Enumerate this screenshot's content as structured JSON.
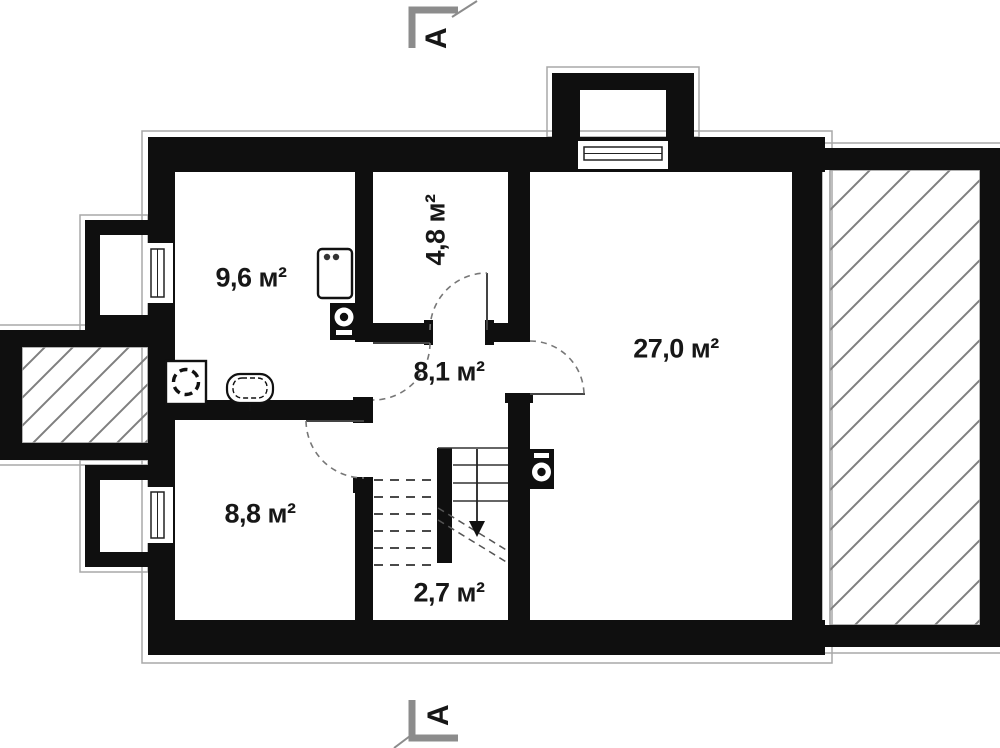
{
  "document": {
    "type": "architectural-floor-plan",
    "units": "м²"
  },
  "rooms": [
    {
      "key": "room-top-left",
      "area_label": "9,6 м²"
    },
    {
      "key": "room-top-middle",
      "area_label": "4,8 м²",
      "label_rotation_deg": -90
    },
    {
      "key": "hallway",
      "area_label": "8,1 м²"
    },
    {
      "key": "room-right",
      "area_label": "27,0 м²"
    },
    {
      "key": "room-bottom-left",
      "area_label": "8,8 м²"
    },
    {
      "key": "stair-landing",
      "area_label": "2,7 м²"
    }
  ],
  "section_markers": {
    "top": {
      "label": "A"
    },
    "bottom": {
      "label": "A"
    }
  },
  "fixtures": [
    {
      "key": "washing-machine"
    },
    {
      "key": "toilet"
    },
    {
      "key": "stove-appliance"
    },
    {
      "key": "boiler-bathroom"
    },
    {
      "key": "water-heater-living-room"
    }
  ],
  "features": [
    {
      "key": "staircase",
      "direction": "down"
    },
    {
      "key": "terrace-right",
      "fill": "diagonal-hatch"
    },
    {
      "key": "porch-left",
      "fill": "diagonal-hatch"
    },
    {
      "key": "chimney-top"
    }
  ],
  "colors": {
    "wall": "#0f0f0f",
    "outline": "#a8a8a8",
    "hatch": "#7f7f7f",
    "door": "#777777",
    "text": "#171717",
    "background": "#ffffff"
  }
}
